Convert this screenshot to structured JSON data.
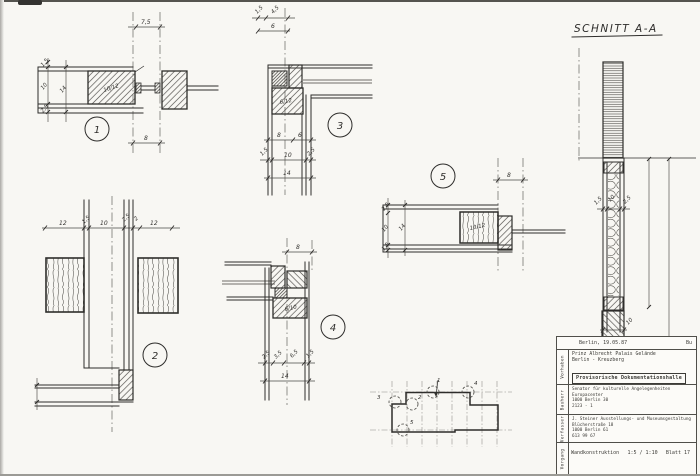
{
  "colors": {
    "ink": "#2e2d2b",
    "paper": "#f8f7f3",
    "gray": "#8a8984"
  },
  "section_label": {
    "title": "SCHNITT A-A"
  },
  "d1": {
    "num": "1",
    "dim_top": "7,5",
    "dim_a": "1,5",
    "dim_b": "10",
    "dim_c": "2,5",
    "dim_total": "14",
    "block": "10/12",
    "dim_bottom": "8"
  },
  "d2": {
    "num": "2",
    "chain": [
      "12",
      "1,5",
      "10",
      "2,5",
      "2",
      "12"
    ]
  },
  "d3": {
    "num": "3",
    "dim_a": "1,5",
    "dim_b": "4,5",
    "dim_top_total": "6",
    "block": "6/12",
    "dim_c": "8",
    "dim_d": "6",
    "dim_e": "1,5",
    "dim_f": "10",
    "dim_g": "2,5",
    "dim_total": "14"
  },
  "d4": {
    "num": "4",
    "dim_top": "8",
    "block": "6/10",
    "chain": [
      "2,5",
      "3,5",
      "6,5",
      "1,5"
    ],
    "dim_total": "14"
  },
  "d5": {
    "num": "5",
    "dim_top": "8",
    "dim_a": "2,5",
    "dim_b": "10",
    "dim_c": "1,5",
    "dim_total": "14",
    "block": "10/12"
  },
  "sec": {
    "dim_a": "1,5",
    "dim_b": "10",
    "dim_c": "2,5",
    "dim_bottom": "10"
  },
  "keyplan": {
    "m1": "1",
    "m2": "2",
    "m3": "3",
    "m4": "4",
    "m5": "5"
  },
  "titleblock": {
    "date": "Berlin, 19.05.87",
    "initials": "Bu",
    "vorhaben_label": "Vorhaben",
    "vorhaben_line1": "Prinz Albrecht Palais Gelände",
    "vorhaben_line2": "Berlin - Kreuzberg",
    "project_title": "Provisorische Dokumentationshalle",
    "bauherr_label": "Bauherr",
    "bauherr_line1": "Senator für kulturelle Angelegenheiten",
    "bauherr_line2": "Europacenter",
    "bauherr_line3": "1000 Berlin 30",
    "bauherr_line4": "2123 - 1",
    "verfasser_label": "Verfasser",
    "verfasser_line1": "J. Steiner Ausstellungs- und Museumsgestaltung",
    "verfasser_line2": "Blücherstraße 18",
    "verfasser_line3": "1000 Berlin 61",
    "verfasser_line4": "613 99 67",
    "vorgang_label": "Vorgang",
    "doc_title": "Wandkonstruktion",
    "scale": "1:5 / 1:10",
    "sheet": "Blatt 17"
  }
}
